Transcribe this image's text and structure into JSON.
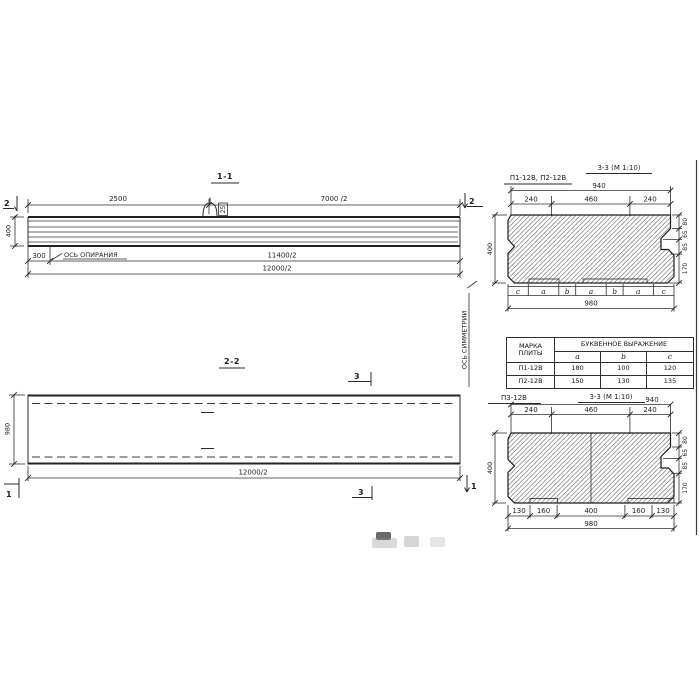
{
  "view_1_1": {
    "title": "1-1",
    "marker_left": "2",
    "marker_right": "2",
    "dim_top_left": "2500",
    "dim_top_right": "7000 /2",
    "dim_height": "400",
    "dim_offset": "300",
    "support_axis_label": "ОСЬ ОПИРАНИЯ",
    "dim_half_inner": "11400/2",
    "dim_half_outer": "12000/2",
    "loop_label": "25"
  },
  "view_2_2": {
    "title": "2-2",
    "dim_height": "980",
    "dim_half_length": "12000/2",
    "marker_section3_top": "3",
    "marker_section3_bottom": "3",
    "marker_left": "1",
    "marker_right": "1",
    "symmetry_axis_label": "ОСЬ СИММЕТРИИ"
  },
  "section_a": {
    "label": "П1-12В, П2-12В",
    "title": "3-3 (М 1:10)",
    "dim_width_top": "940",
    "dims_top": [
      "240",
      "460",
      "240"
    ],
    "dim_height": "400",
    "dims_right": [
      "80",
      "65",
      "85",
      "170"
    ],
    "letters": [
      "c",
      "a",
      "b",
      "a",
      "b",
      "a",
      "c"
    ],
    "dim_width_bottom": "980"
  },
  "table": {
    "header_col1": "МАРКА ПЛИТЫ",
    "header_span": "БУКВЕННОЕ ВЫРАЖЕНИЕ",
    "sub_headers": [
      "a",
      "b",
      "c"
    ],
    "rows": [
      {
        "mark": "П1-12В",
        "a": "180",
        "b": "100",
        "c": "120"
      },
      {
        "mark": "П2-12В",
        "a": "150",
        "b": "130",
        "c": "135"
      }
    ]
  },
  "section_b": {
    "label": "П3-12В",
    "title": "3-3 (М 1:10)",
    "dim_width_top": "940",
    "dims_top": [
      "240",
      "460",
      "240"
    ],
    "dim_height": "400",
    "dims_right": [
      "80",
      "65",
      "85",
      "170"
    ],
    "dims_bottom": [
      "130",
      "160",
      "400",
      "160",
      "130"
    ],
    "dim_width_bottom": "980"
  }
}
